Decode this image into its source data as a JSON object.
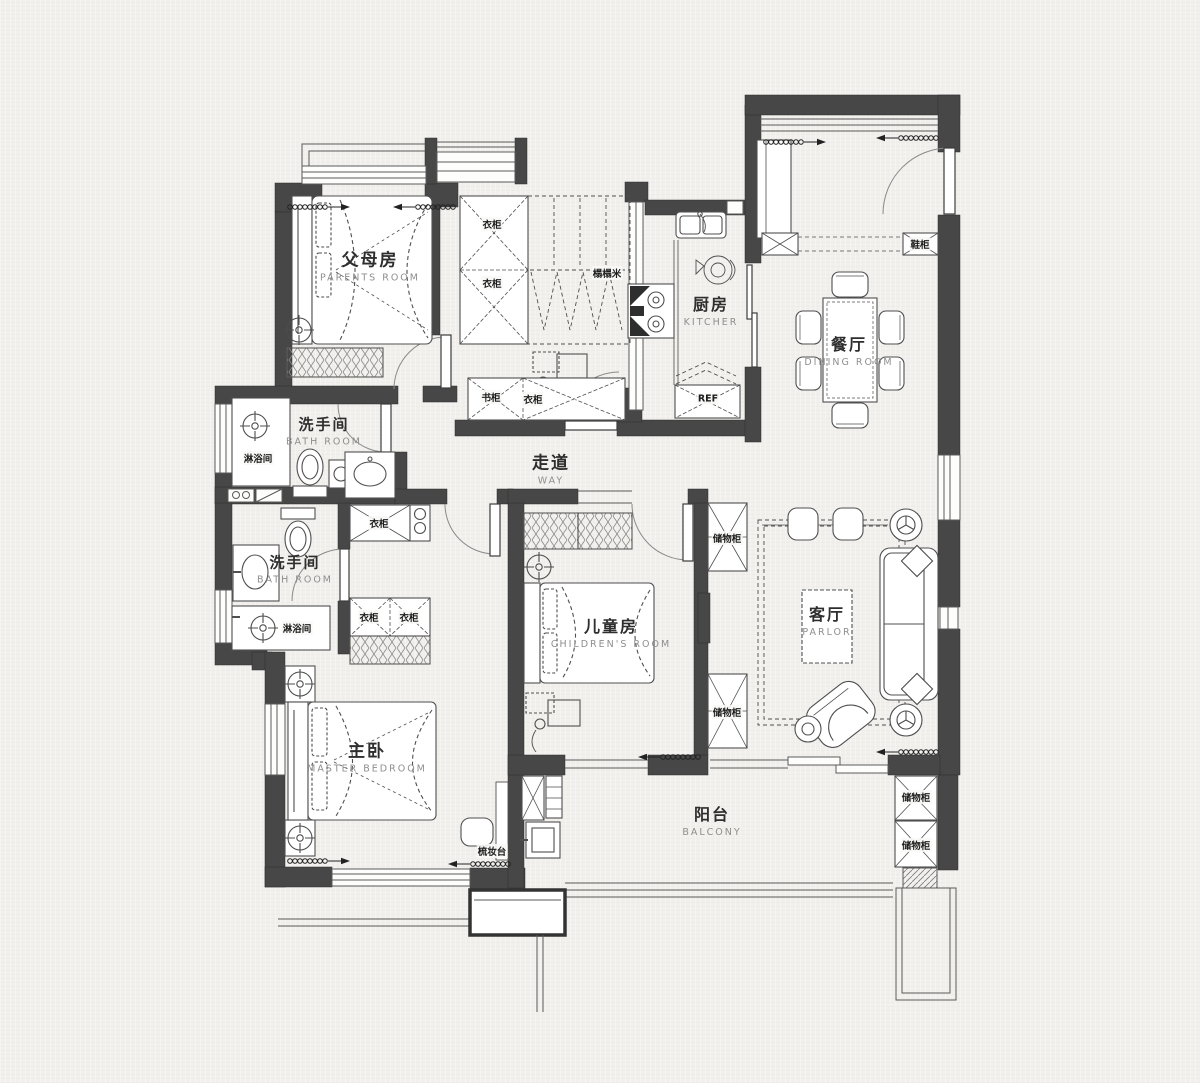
{
  "colors": {
    "paper": "#f1f0ed",
    "wall": "#474747",
    "ink": "#2e2e2e",
    "muted": "#8e8e8e",
    "thin_line": "#555555"
  },
  "rooms": [
    {
      "id": "parents-room",
      "cn": "父母房",
      "en": "PARENTS ROOM",
      "x": 370,
      "y": 267,
      "size": 17
    },
    {
      "id": "kitchen",
      "cn": "厨房",
      "en": "KITCHER",
      "x": 711,
      "y": 312,
      "size": 16
    },
    {
      "id": "dining-room",
      "cn": "餐厅",
      "en": "DINING ROOM",
      "x": 849,
      "y": 352,
      "size": 16
    },
    {
      "id": "bath-room-1",
      "cn": "洗手间",
      "en": "BATH ROOM",
      "x": 324,
      "y": 432,
      "size": 15
    },
    {
      "id": "corridor",
      "cn": "走道",
      "en": "WAY",
      "x": 551,
      "y": 470,
      "size": 17
    },
    {
      "id": "bath-room-2",
      "cn": "洗手间",
      "en": "BATH ROOM",
      "x": 295,
      "y": 570,
      "size": 15
    },
    {
      "id": "childrens-room",
      "cn": "儿童房",
      "en": "CHILDREN'S ROOM",
      "x": 611,
      "y": 634,
      "size": 16
    },
    {
      "id": "parlor",
      "cn": "客厅",
      "en": "PARLOR",
      "x": 827,
      "y": 622,
      "size": 16
    },
    {
      "id": "master-bedroom",
      "cn": "主卧",
      "en": "MASTER BEDROOM",
      "x": 367,
      "y": 758,
      "size": 17
    },
    {
      "id": "balcony",
      "cn": "阳台",
      "en": "BALCONY",
      "x": 712,
      "y": 822,
      "size": 16
    }
  ],
  "fixtures": [
    {
      "text": "衣柜",
      "x": 492,
      "y": 224
    },
    {
      "text": "衣柜",
      "x": 492,
      "y": 283
    },
    {
      "text": "榻榻米",
      "x": 607,
      "y": 273
    },
    {
      "text": "书柜",
      "x": 491,
      "y": 397
    },
    {
      "text": "衣柜",
      "x": 533,
      "y": 399
    },
    {
      "text": "REF",
      "x": 708,
      "y": 399
    },
    {
      "text": "鞋柜",
      "x": 920,
      "y": 244
    },
    {
      "text": "淋浴间",
      "x": 258,
      "y": 458
    },
    {
      "text": "淋浴间",
      "x": 297,
      "y": 628
    },
    {
      "text": "衣柜",
      "x": 379,
      "y": 523
    },
    {
      "text": "衣柜",
      "x": 369,
      "y": 617
    },
    {
      "text": "衣柜",
      "x": 409,
      "y": 617
    },
    {
      "text": "储物柜",
      "x": 727,
      "y": 538
    },
    {
      "text": "储物柜",
      "x": 727,
      "y": 712
    },
    {
      "text": "储物柜",
      "x": 916,
      "y": 797
    },
    {
      "text": "储物柜",
      "x": 916,
      "y": 845
    },
    {
      "text": "梳妆台",
      "x": 492,
      "y": 851
    }
  ]
}
